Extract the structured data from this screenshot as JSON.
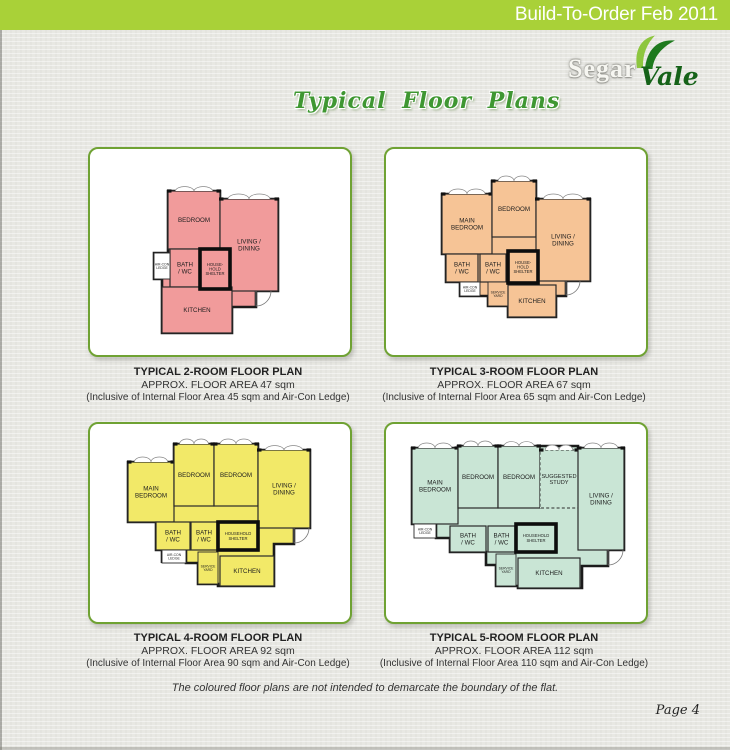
{
  "header": {
    "title": "Build-To-Order Feb 2011"
  },
  "logo": {
    "segar": "Segar",
    "vale": "Vale"
  },
  "page_title": "Typical Floor Plans",
  "colors": {
    "banner_green": "#a9d138",
    "panel_border": "#6fa233",
    "title_green": "#3f9732",
    "logo_dark_green": "#156218",
    "leaf_light": "#8dc63f",
    "leaf_dark": "#1e7a1e",
    "wall": "#1b1b1b"
  },
  "footer": {
    "note": "The coloured floor plans are not intended to demarcate the boundary of the flat.",
    "page": "Page 4"
  },
  "plans": [
    {
      "name": "2-Room",
      "caption_title": "TYPICAL 2-ROOM FLOOR PLAN",
      "caption_area": "APPROX. FLOOR AREA 47 sqm",
      "caption_inclusive": "(Inclusive of Internal Floor Area 45 sqm and Air-Con Ledge)",
      "fill": "#f19b9b",
      "outline": "78,42 130,42 130,50 188,50 188,142 166,142 166,158 142,158 142,184 72,184 72,130 64,130 64,104 78,104",
      "door": {
        "hx": 166,
        "hy": 142,
        "r": 15
      },
      "rooms": [
        {
          "label": "BEDROOM",
          "x": 78,
          "y": 42,
          "w": 52,
          "h": 58,
          "win": true
        },
        {
          "label": "LIVING /\nDINING",
          "x": 130,
          "y": 50,
          "w": 58,
          "h": 92,
          "win": true
        },
        {
          "label": "BATH\n/ WC",
          "x": 80,
          "y": 100,
          "w": 30,
          "h": 38
        },
        {
          "label": "AIR-CON\nLEDGE",
          "x": 64,
          "y": 104,
          "w": 16,
          "h": 26,
          "style": "small",
          "white": true
        },
        {
          "label": "KITCHEN",
          "x": 72,
          "y": 138,
          "w": 70,
          "h": 46
        },
        {
          "label": "HOUSE-\nHOLD\nSHELTER",
          "x": 110,
          "y": 100,
          "w": 30,
          "h": 40,
          "style": "shelter"
        }
      ]
    },
    {
      "name": "3-Room",
      "caption_title": "TYPICAL 3-ROOM FLOOR PLAN",
      "caption_area": "APPROX. FLOOR AREA 67 sqm",
      "caption_inclusive": "(Inclusive of Internal Floor Area 65 sqm and Air-Con Ledge)",
      "fill": "#f6c496",
      "outline": "56,45 106,45 106,32 150,32 150,50 204,50 204,132 180,132 180,147 170,147 170,168 122,168 122,157 102,157 102,147 74,147 74,133 60,133 60,105 56,105",
      "door": {
        "hx": 180,
        "hy": 132,
        "r": 14
      },
      "rooms": [
        {
          "label": "MAIN\nBEDROOM",
          "x": 56,
          "y": 45,
          "w": 50,
          "h": 60,
          "win": true
        },
        {
          "label": "BEDROOM",
          "x": 106,
          "y": 32,
          "w": 44,
          "h": 56,
          "win": true
        },
        {
          "label": "LIVING /\nDINING",
          "x": 150,
          "y": 50,
          "w": 54,
          "h": 82,
          "win": true
        },
        {
          "label": "BATH\n/ WC",
          "x": 60,
          "y": 105,
          "w": 32,
          "h": 28
        },
        {
          "label": "BATH\n/ WC",
          "x": 94,
          "y": 105,
          "w": 26,
          "h": 28
        },
        {
          "label": "AIR-CON\nLEDGE",
          "x": 74,
          "y": 133,
          "w": 20,
          "h": 14,
          "style": "small",
          "white": true
        },
        {
          "label": "SERVICE\nYARD",
          "x": 102,
          "y": 133,
          "w": 20,
          "h": 24,
          "style": "small"
        },
        {
          "label": "KITCHEN",
          "x": 122,
          "y": 136,
          "w": 48,
          "h": 32
        },
        {
          "label": "HOUSE-\nHOLD\nSHELTER",
          "x": 122,
          "y": 102,
          "w": 30,
          "h": 32,
          "style": "shelter"
        }
      ]
    },
    {
      "name": "4-Room",
      "caption_title": "TYPICAL 4-ROOM FLOOR PLAN",
      "caption_area": "APPROX. FLOOR AREA 92 sqm",
      "caption_inclusive": "(Inclusive of Internal Floor Area 90 sqm and Air-Con Ledge)",
      "fill": "#f2e968",
      "outline": "38,38 84,38 84,20 168,20 168,26 220,26 220,104 204,104 204,120 184,120 184,162 128,162 128,160 108,160 108,139 96,139 96,126 72,126 72,139 72,126 66,126 66,98 38,98",
      "door": {
        "hx": 204,
        "hy": 104,
        "r": 15
      },
      "rooms": [
        {
          "label": "MAIN\nBEDROOM",
          "x": 38,
          "y": 38,
          "w": 46,
          "h": 60,
          "win": true
        },
        {
          "label": "BEDROOM",
          "x": 84,
          "y": 20,
          "w": 40,
          "h": 62,
          "win": true
        },
        {
          "label": "BEDROOM",
          "x": 124,
          "y": 20,
          "w": 44,
          "h": 62,
          "win": true
        },
        {
          "label": "LIVING /\nDINING",
          "x": 168,
          "y": 26,
          "w": 52,
          "h": 78,
          "win": true
        },
        {
          "label": "BATH\n/ WC",
          "x": 66,
          "y": 98,
          "w": 34,
          "h": 28
        },
        {
          "label": "BATH\n/ WC",
          "x": 101,
          "y": 98,
          "w": 26,
          "h": 28
        },
        {
          "label": "AIR-CON\nLEDGE",
          "x": 72,
          "y": 126,
          "w": 24,
          "h": 13,
          "style": "small",
          "white": true
        },
        {
          "label": "SERVICE\nYARD",
          "x": 108,
          "y": 128,
          "w": 20,
          "h": 32,
          "style": "small"
        },
        {
          "label": "KITCHEN",
          "x": 130,
          "y": 132,
          "w": 54,
          "h": 30
        },
        {
          "label": "HOUSEHOLD\nSHELTER",
          "x": 128,
          "y": 98,
          "w": 40,
          "h": 28,
          "style": "shelter"
        }
      ]
    },
    {
      "name": "5-Room",
      "caption_title": "TYPICAL 5-ROOM FLOOR PLAN",
      "caption_area": "APPROX. FLOOR AREA 112 sqm",
      "caption_inclusive": "(Inclusive of Internal Floor Area 110 sqm and Air-Con Ledge)",
      "fill": "#c9e5d5",
      "outline": "26,24 72,24 72,22 192,22 192,24 238,24 238,126 222,126 222,142 196,142 196,164 132,164 132,162 110,162 110,141 100,141 100,128 64,128 64,114 50,114 50,100 26,100",
      "door": {
        "hx": 222,
        "hy": 126,
        "r": 15
      },
      "rooms": [
        {
          "label": "MAIN\nBEDROOM",
          "x": 26,
          "y": 24,
          "w": 46,
          "h": 76,
          "win": true
        },
        {
          "label": "BEDROOM",
          "x": 72,
          "y": 22,
          "w": 40,
          "h": 62,
          "win": true
        },
        {
          "label": "BEDROOM",
          "x": 112,
          "y": 22,
          "w": 42,
          "h": 62,
          "win": true
        },
        {
          "label": "SUGGESTED\nSTUDY",
          "x": 154,
          "y": 26,
          "w": 38,
          "h": 58,
          "style": "dashed",
          "win": true
        },
        {
          "label": "LIVING /\nDINING",
          "x": 192,
          "y": 24,
          "w": 46,
          "h": 102,
          "win": true
        },
        {
          "label": "AIR-CON\nLEDGE",
          "x": 28,
          "y": 100,
          "w": 22,
          "h": 14,
          "style": "small",
          "white": true
        },
        {
          "label": "BATH\n/ WC",
          "x": 64,
          "y": 102,
          "w": 36,
          "h": 26
        },
        {
          "label": "BATH\n/ WC",
          "x": 102,
          "y": 102,
          "w": 27,
          "h": 26
        },
        {
          "label": "SERVICE\nYARD",
          "x": 110,
          "y": 130,
          "w": 20,
          "h": 32,
          "style": "small"
        },
        {
          "label": "KITCHEN",
          "x": 132,
          "y": 134,
          "w": 62,
          "h": 30
        },
        {
          "label": "HOUSEHOLD\nSHELTER",
          "x": 130,
          "y": 100,
          "w": 40,
          "h": 28,
          "style": "shelter"
        }
      ]
    }
  ]
}
